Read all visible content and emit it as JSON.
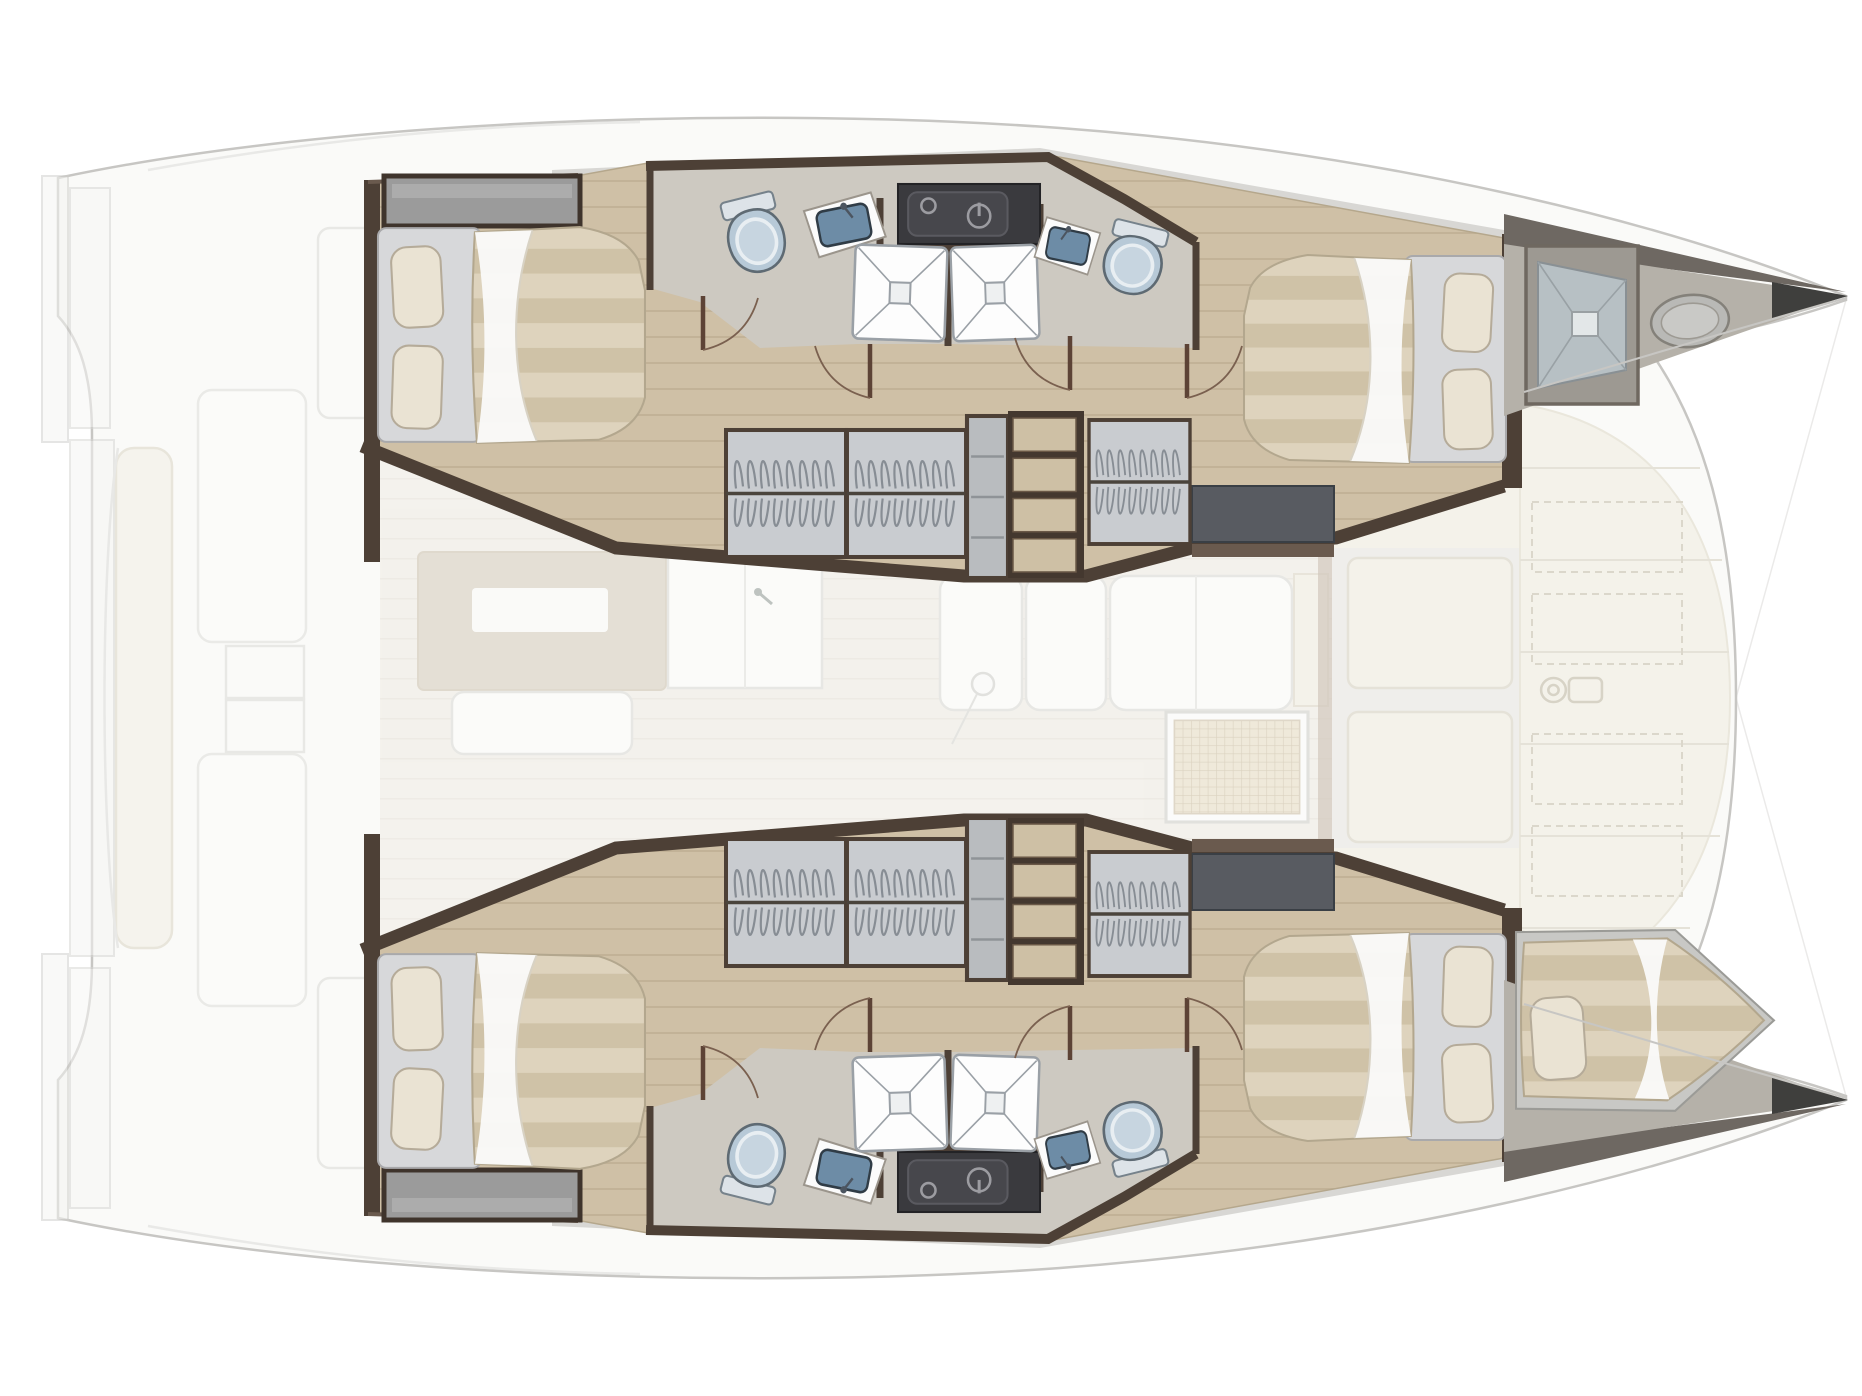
{
  "title": "Catamaran yacht interior layout – top view floor plan",
  "diagram": {
    "type": "floor-plan",
    "subject": "sailing-catamaran",
    "view": "top-down",
    "bow_direction": "right",
    "zones": {
      "port_hull": {
        "position": "top",
        "cabins": 2,
        "toilets": 2,
        "showers": 2,
        "sinks": 2,
        "wardrobes": 3,
        "stairs": 1,
        "bow": "deck-hatch"
      },
      "starboard_hull": {
        "position": "bottom",
        "cabins": 2,
        "toilets": 2,
        "showers": 2,
        "sinks": 2,
        "wardrobes": 3,
        "stairs": 1,
        "bow": "single-berth"
      },
      "saloon": {
        "position": "center",
        "style": "faded",
        "features": [
          "galley-island",
          "galley-sink",
          "sofa",
          "bench",
          "deck-grate"
        ]
      },
      "aft_cockpit": {
        "position": "left",
        "style": "faded",
        "features": [
          "transom-steps",
          "aft-bench",
          "cockpit-tables"
        ]
      },
      "foredeck": {
        "position": "right-center",
        "style": "faded",
        "features": [
          "locker-hatches",
          "windlass",
          "forward-cockpit"
        ]
      }
    },
    "totals": {
      "double_beds": 4,
      "bow_berths": 1,
      "toilets": 4,
      "bathroom_sinks": 4,
      "showers": 4,
      "wardrobes": 6,
      "staircases": 2
    }
  },
  "colors": {
    "background": "#ffffff",
    "outline": "#c7c6c3",
    "shell": "#fafaf8",
    "wood": "#cfc0a6",
    "wood_line": "#b7a68a",
    "wall": "#4d4036",
    "wall_light": "#6a5a4e",
    "bath_floor": "#cdc9c1",
    "side_deck": "#d8d7d4",
    "mattress_a": "#ded3bd",
    "mattress_b": "#cfc2a7",
    "sheet": "#fafaf9",
    "pillow": "#eae3d3",
    "pillow_edge": "#b5ab99",
    "bed_base": "#d7d8da",
    "toilet": "#b7c9d7",
    "toilet_rim": "#e8eef2",
    "basin": "#6d8ca6",
    "counter": "#fbfbfb",
    "shower": "#fdfdfd",
    "shower_line": "#9aa0a6",
    "dark_unit": "#3a3a3e",
    "dark_unit_panel": "#47474c",
    "unit_icon": "#9c9ca1",
    "wardrobe": "#c9ccd0",
    "hanger": "#878d94",
    "rod": "#4a443c",
    "stair_tread": "#cec0a5",
    "stair_frame": "#44382f",
    "platform": "#585b61",
    "saloon_floor": "#f0ede6",
    "furniture": "#fcfcfb",
    "furniture_line": "#dcdcd8",
    "galley": "#d8cfc1",
    "cream": "#f1eee3",
    "cream_line": "#d9d4c6",
    "grate_a": "#e9dfc9",
    "grate_b": "#c9bb9f",
    "bow_deck": "#b5b1a9",
    "bow_roof": "#6e6862",
    "bow_tip": "#3f3f3d",
    "deck_gray": "#e9e8e4"
  },
  "fixtures": [
    {
      "type": "sideboard",
      "frame": "hull",
      "x": 384,
      "y": 176,
      "w": 196,
      "h": 50
    },
    {
      "type": "bed",
      "frame": "hull",
      "x": 378,
      "y": 224,
      "w": 268,
      "h": 222
    },
    {
      "type": "toilet",
      "frame": "hull",
      "x": 720,
      "y": 196,
      "w": 70,
      "h": 76,
      "rot": -14
    },
    {
      "type": "sink",
      "frame": "hull",
      "x": 804,
      "y": 196,
      "w": 80,
      "h": 58,
      "rot": -7
    },
    {
      "type": "darkunit",
      "frame": "hull",
      "x": 898,
      "y": 184,
      "w": 142,
      "h": 60
    },
    {
      "type": "shower",
      "frame": "hull",
      "x": 853,
      "y": 245,
      "w": 94,
      "h": 96,
      "rot": 2
    },
    {
      "type": "shower",
      "frame": "hull",
      "x": 951,
      "y": 245,
      "w": 88,
      "h": 96,
      "rot": -2
    },
    {
      "type": "sink",
      "frame": "hull",
      "x": 1036,
      "y": 220,
      "w": 64,
      "h": 52,
      "rot": 7,
      "flip": true
    },
    {
      "type": "toilet",
      "frame": "hull",
      "x": 1098,
      "y": 224,
      "w": 72,
      "h": 70,
      "rot": 14,
      "flip": true
    },
    {
      "type": "wardrobe",
      "frame": "hull",
      "x": 726,
      "y": 430,
      "w": 120,
      "h": 127
    },
    {
      "type": "wardrobe",
      "frame": "hull",
      "x": 847,
      "y": 430,
      "w": 119,
      "h": 127
    },
    {
      "type": "cabinet",
      "frame": "hull",
      "x": 967,
      "y": 416,
      "w": 41,
      "h": 162
    },
    {
      "type": "stairs",
      "frame": "hull",
      "x": 1008,
      "y": 411,
      "w": 76,
      "h": 167
    },
    {
      "type": "wardrobe",
      "frame": "hull",
      "x": 1089,
      "y": 420,
      "w": 101,
      "h": 124
    },
    {
      "type": "bed",
      "frame": "hull",
      "x": 1243,
      "y": 252,
      "w": 263,
      "h": 214,
      "flip": true
    },
    {
      "type": "door",
      "frame": "hull",
      "x": 702,
      "y": 296
    },
    {
      "type": "door",
      "frame": "hull",
      "x": 814,
      "y": 344,
      "flip": true
    },
    {
      "type": "door",
      "frame": "hull",
      "x": 1014,
      "y": 336,
      "flip": true
    },
    {
      "type": "door",
      "frame": "hull",
      "x": 1186,
      "y": 344
    },
    {
      "type": "hatch",
      "frame": "bow-top",
      "x": 1526,
      "y": 246,
      "w": 112,
      "h": 158
    },
    {
      "type": "ovalhatch",
      "frame": "bow-top",
      "x": 1650,
      "y": 294,
      "w": 80,
      "h": 54,
      "rot": -6
    },
    {
      "type": "bowberth",
      "frame": "bow-bottom",
      "x": 1516,
      "y": 930,
      "w": 262,
      "h": 184
    },
    {
      "type": "grate",
      "frame": "saloon",
      "x": 1166,
      "y": 712,
      "w": 142,
      "h": 110
    },
    {
      "type": "winch",
      "frame": "foredeck",
      "x": 1538,
      "y": 666,
      "w": 66,
      "h": 46
    }
  ]
}
